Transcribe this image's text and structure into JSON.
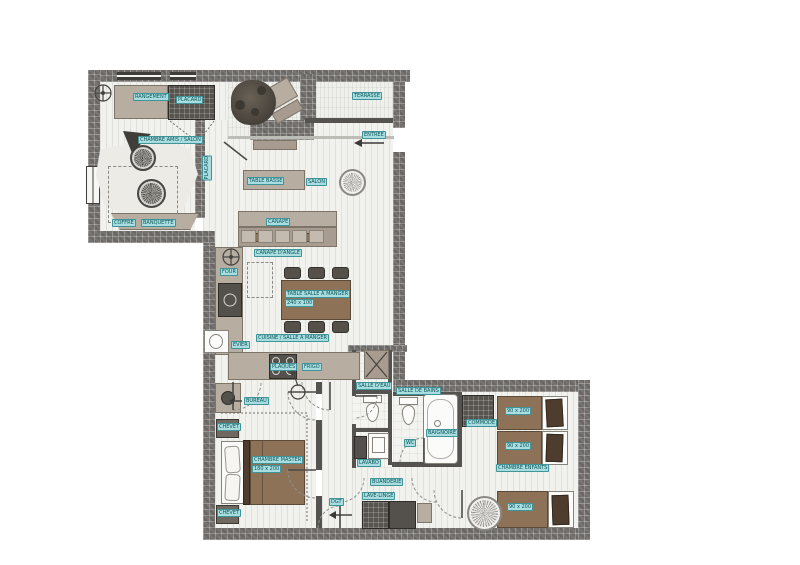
{
  "document": {
    "kind": "apartment floor plan drawing"
  },
  "colors": {
    "wall": "#767370",
    "floor": "#f1f1ee",
    "wood_furniture": "#8d7257",
    "light_furniture": "#b7ada1",
    "label_background": "#a9dde0",
    "label_text": "#0b5459"
  },
  "labels": {
    "guest": {
      "room": "CHAMBRE AMIS / SALON",
      "storage": "RANGEMENT",
      "closet": "PLACARD",
      "bench": "BANQUETTE",
      "chest": "COFFRE"
    },
    "terrace": {
      "room": "TERRASSE"
    },
    "entry": {
      "label": "ENTREE"
    },
    "living": {
      "room": "SALON",
      "coffee_table": "TABLE BASSE",
      "sofa": "CANAPE",
      "sofa_type": "CANAPE D'ANGLE",
      "corridor_closet": "PLACARD"
    },
    "dining": {
      "table": "TABLE SALLE A MANGER",
      "table_size": "240 x 100"
    },
    "kitchen": {
      "room": "CUISINE / SALLE A MANGER",
      "oven": "FOUR",
      "sink": "EVIER",
      "hob": "PLAQUES",
      "fridge": "FRIGO"
    },
    "bath": {
      "shower_room": "SALLE D'EAU",
      "bathroom": "SALLE DE BAINS",
      "basin": "LAVABO",
      "wc": "WC",
      "bathtub": "BAIGNOIRE"
    },
    "master": {
      "room": "CHAMBRE MASTER",
      "bed_size": "180 x 200",
      "nightstand": "CHEVET",
      "desk": "BUREAU"
    },
    "hallway": {
      "label": "DGT",
      "laundry": "BUANDERIE",
      "washer": "LAVE-LINGE"
    },
    "kids": {
      "room": "CHAMBRE ENFANTS",
      "bed_size": "90 x 200",
      "dresser": "COMMODE"
    }
  }
}
